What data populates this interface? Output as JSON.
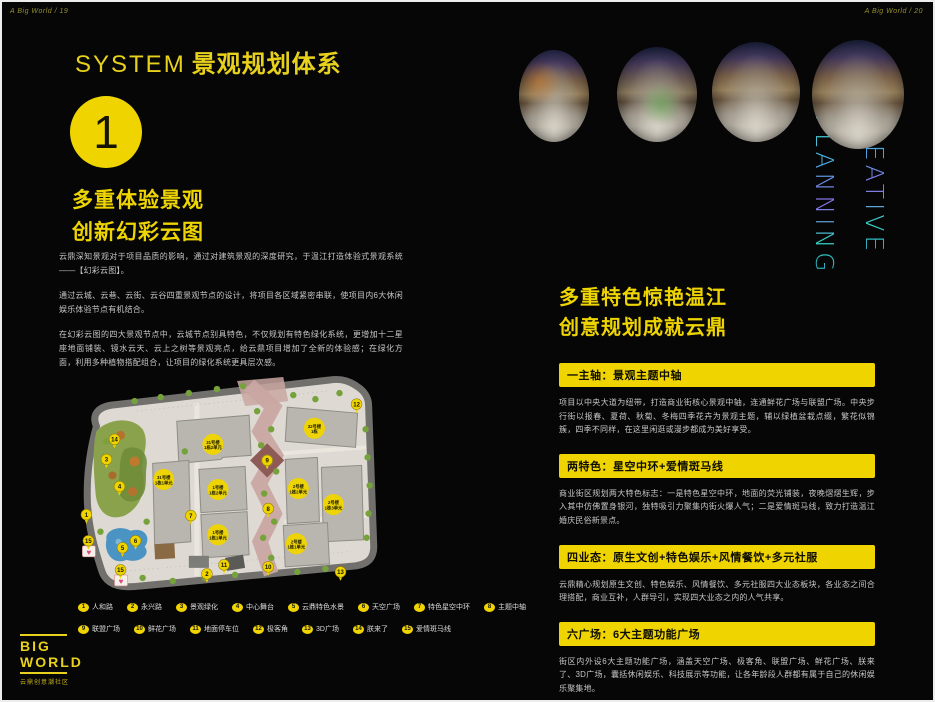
{
  "meta": {
    "accent": "#f0d400",
    "neon_teal": "#43e8cf",
    "neon_purple": "#8a6fe8",
    "body_text": "#c6c6c6"
  },
  "page_left": {
    "header": "A Big World / 19",
    "title_en": "SYSTEM",
    "title_zh": "景观规划体系",
    "badge_number": "1",
    "heading_lines": [
      "多重体验景观",
      "创新幻彩云图"
    ],
    "paragraphs": [
      "云鼎深知景观对于项目品质的影响，通过对建筑景观的深度研究，于温江打造体验式景观系统——【幻彩云图】。",
      "通过云城、云巷、云街、云谷四重景观节点的设计，将项目各区域紧密串联，使项目内6大休闲娱乐体验节点有机结合。",
      "在幻彩云图的四大景观节点中，云城节点别具特色，不仅规划有特色绿化系统，更增加十二星座地面铺装、镜水云天、云上之树等景观亮点，给云鼎项目增加了全新的体验感；在绿化方面，利用多种植物搭配组合，让项目的绿化系统更具层次感。"
    ],
    "map": {
      "building_labels": [
        {
          "x": 136,
          "y": 73,
          "l1": "31号楼",
          "l2": "1栋2单元"
        },
        {
          "x": 87,
          "y": 108,
          "l1": "31号楼",
          "l2": "1栋1单元"
        },
        {
          "x": 237,
          "y": 57,
          "l1": "32号楼",
          "l2": "1栋"
        },
        {
          "x": 141,
          "y": 118,
          "l1": "1号楼",
          "l2": "1栋2单元"
        },
        {
          "x": 141,
          "y": 163,
          "l1": "1号楼",
          "l2": "1栋1单元"
        },
        {
          "x": 221,
          "y": 117,
          "l1": "2号楼",
          "l2": "1栋2单元"
        },
        {
          "x": 256,
          "y": 133,
          "l1": "2号楼",
          "l2": "1栋3单元"
        },
        {
          "x": 219,
          "y": 172,
          "l1": "2号楼",
          "l2": "1栋1单元"
        }
      ],
      "markers": [
        {
          "n": "1",
          "x": 10,
          "y": 143
        },
        {
          "n": "2",
          "x": 130,
          "y": 202
        },
        {
          "n": "3",
          "x": 30,
          "y": 88
        },
        {
          "n": "4",
          "x": 43,
          "y": 115
        },
        {
          "n": "5",
          "x": 46,
          "y": 176
        },
        {
          "n": "6",
          "x": 59,
          "y": 169
        },
        {
          "n": "7",
          "x": 114,
          "y": 144
        },
        {
          "n": "8",
          "x": 191,
          "y": 137
        },
        {
          "n": "9",
          "x": 190,
          "y": 89
        },
        {
          "n": "10",
          "x": 191,
          "y": 195
        },
        {
          "n": "11",
          "x": 147,
          "y": 193
        },
        {
          "n": "12",
          "x": 279,
          "y": 33
        },
        {
          "n": "13",
          "x": 263,
          "y": 200
        },
        {
          "n": "14",
          "x": 38,
          "y": 68
        },
        {
          "n": "15",
          "x": 12,
          "y": 169
        },
        {
          "n": "15",
          "x": 44,
          "y": 198
        }
      ]
    },
    "legend": [
      [
        {
          "n": "1",
          "label": "人和路"
        },
        {
          "n": "2",
          "label": "永兴路"
        },
        {
          "n": "3",
          "label": "景观绿化"
        },
        {
          "n": "4",
          "label": "中心舞台"
        },
        {
          "n": "5",
          "label": "云鼎特色水景"
        },
        {
          "n": "6",
          "label": "天空广场"
        },
        {
          "n": "7",
          "label": "特色星空中环"
        },
        {
          "n": "8",
          "label": "主题中轴"
        }
      ],
      [
        {
          "n": "9",
          "label": "联盟广场"
        },
        {
          "n": "10",
          "label": "鲜花广场"
        },
        {
          "n": "11",
          "label": "地面停车位"
        },
        {
          "n": "12",
          "label": "极客角"
        },
        {
          "n": "13",
          "label": "3D广场"
        },
        {
          "n": "14",
          "label": "朕来了"
        },
        {
          "n": "15",
          "label": "爱情斑马线"
        }
      ]
    ],
    "logo": {
      "line1": "BIG",
      "line2": "WORLD",
      "subtitle": "云鼎创意潮社区"
    }
  },
  "page_right": {
    "header": "A Big World / 20",
    "vertical_text": {
      "word1": "CREATIVE",
      "word2": "PLANNING"
    },
    "heading_lines": [
      "多重特色惊艳温江",
      "创意规划成就云鼎"
    ],
    "sections": [
      {
        "bar": "一主轴：景观主题中轴",
        "text": "项目以中央大道为纽带，打造商业街核心景观中轴，连通鲜花广场与联盟广场。中央步行街以报春、夏荷、秋菊、冬梅四季花卉为景观主题，辅以绿植盆栽点缀，繁花似锦簇，四季不同样，在这里闲逛或漫步都成为美好享受。"
      },
      {
        "bar": "两特色：星空中环+爱情斑马线",
        "text": "商业街区规划两大特色标志：一是特色星空中环，地面的荧光铺装，夜晚熠熠生辉，步入其中仿佛置身银河，独特吸引力聚集内街火爆人气；二是爱情斑马线，致力打造温江婚庆民俗新景点。"
      },
      {
        "bar": "四业态：原生文创+特色娱乐+风情餐饮+多元社服",
        "text": "云鼎精心规划原生文创、特色娱乐、风情餐饮、多元社服四大业态板块，各业态之间合理搭配，商业互补，人群导引，实现四大业态之内的人气共享。"
      },
      {
        "bar": "六广场：6大主题功能广场",
        "text": "街区内外设6大主题功能广场，涵盖天空广场、极客角、联盟广场、鲜花广场、朕来了、3D广场，囊括休闲娱乐、科技展示等功能，让各年龄段人群都有属于自己的休闲娱乐聚集地。"
      }
    ]
  }
}
